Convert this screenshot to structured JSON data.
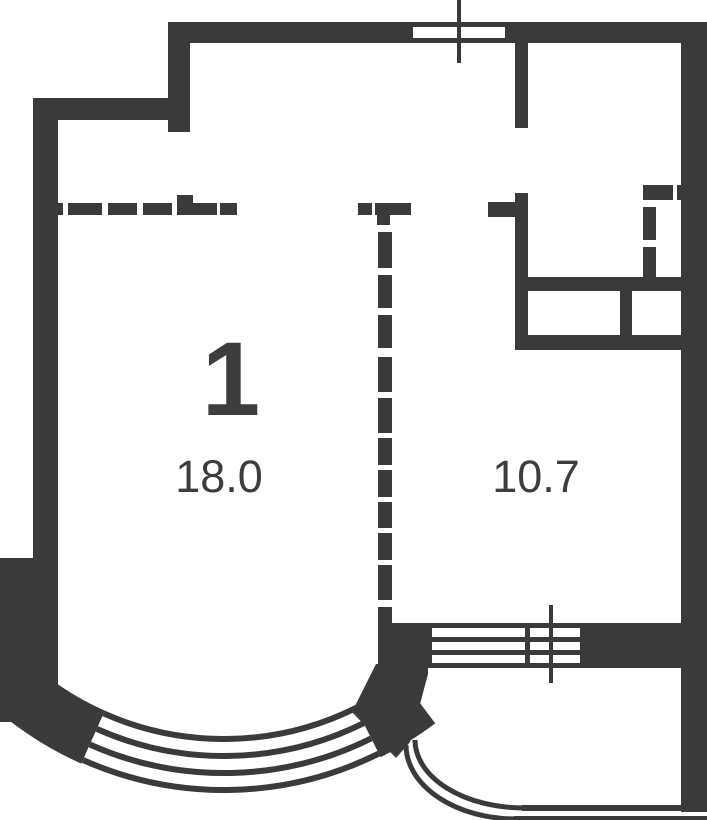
{
  "plan": {
    "unit_number": "1",
    "rooms": [
      {
        "id": "main-room",
        "area": "18.0"
      },
      {
        "id": "second-room",
        "area": "10.7"
      }
    ],
    "colors": {
      "wall": "#3a3a3c",
      "text": "#3d3d3f",
      "background": "#ffffff"
    }
  }
}
